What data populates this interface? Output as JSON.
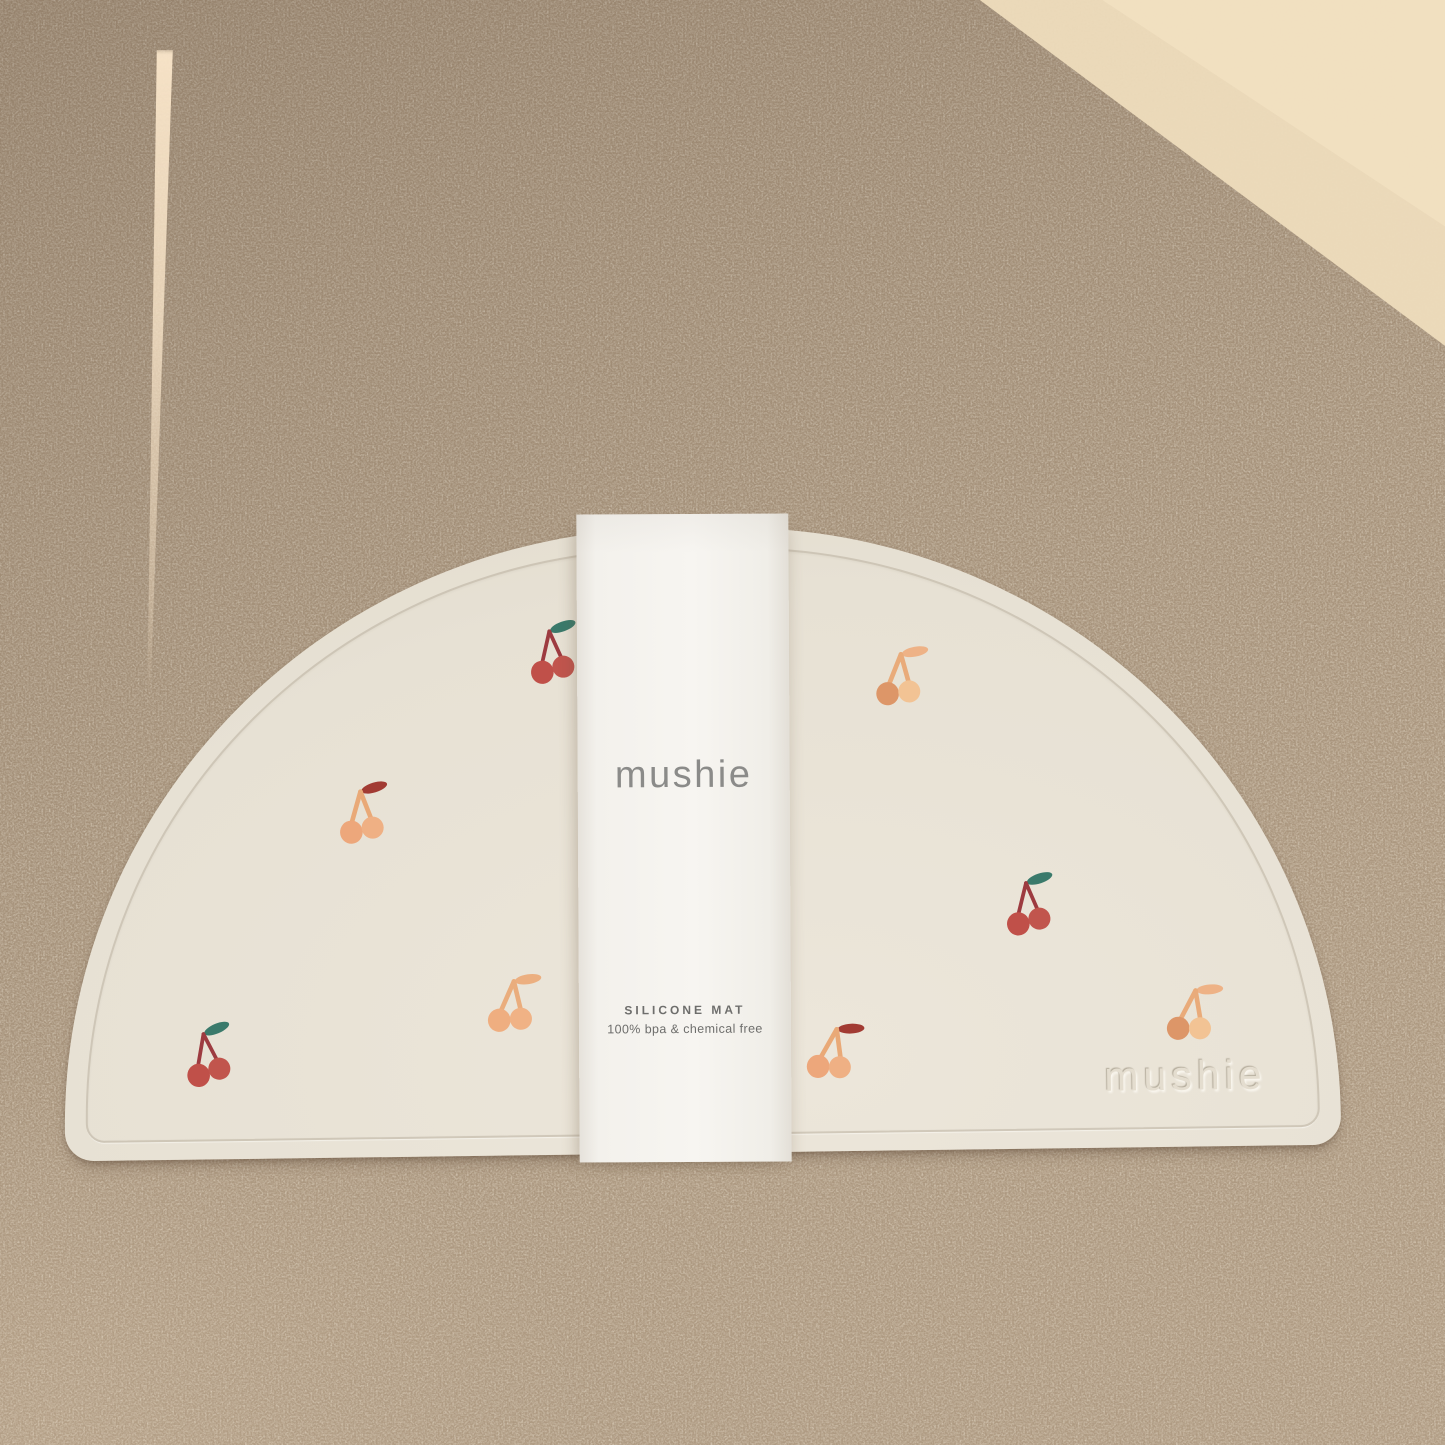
{
  "product": {
    "band": {
      "brand": "mushie",
      "product_name": "SILICONE MAT",
      "tagline": "100% bpa & chemical free"
    },
    "mat": {
      "embossed_logo": "mushie"
    }
  },
  "colors": {
    "cork_shadow": "#a8947c",
    "cork_sunlit": "#eedcbc",
    "mat_cream": "#e7e1d4",
    "band_white": "#f7f5f1",
    "cherry_red": "#c05049",
    "cherry_red_stem": "#9d3b40",
    "leaf_green": "#3a7a6b",
    "cherry_orange": "#eda77b",
    "leaf_dark_red": "#a23b33"
  },
  "cherry_variants": {
    "red": {
      "leaf": "#3a7a6b",
      "stem": "#9d3b40",
      "stem_width": 6.5,
      "body_left": "#c05049",
      "body_right": "#c1554d"
    },
    "orange_red_leaf": {
      "leaf": "#a23b33",
      "stem": "#e9a977",
      "stem_width": 8,
      "body_left": "#eda77b",
      "body_right": "#efb084"
    },
    "orange": {
      "leaf": "#eeb286",
      "stem": "#e9ab7a",
      "stem_width": 8,
      "body_left": "#dd9668",
      "body_right": "#f2c394"
    },
    "orange_soft": {
      "leaf": "#ecaf80",
      "stem": "#eaad7d",
      "stem_width": 8,
      "body_left": "#efae80",
      "body_right": "#f0b285"
    }
  },
  "icons": {
    "cherries": [
      {
        "id": "cherry-top-left-red",
        "variant": "red",
        "x": 466,
        "y": 90,
        "rot": -5
      },
      {
        "id": "cherry-left-orange",
        "variant": "orange_red_leaf",
        "x": 274,
        "y": 248,
        "rot": -2
      },
      {
        "id": "cherry-bottom-left-red",
        "variant": "red",
        "x": 116,
        "y": 488,
        "rot": -8
      },
      {
        "id": "cherry-mid-left-orange",
        "variant": "orange_soft",
        "x": 422,
        "y": 440,
        "rot": 6
      },
      {
        "id": "cherry-right-top-orange",
        "variant": "orange",
        "x": 814,
        "y": 118,
        "rot": 4
      },
      {
        "id": "cherry-right-red",
        "variant": "red",
        "x": 939,
        "y": 348,
        "rot": -4
      },
      {
        "id": "cherry-bottom-mid-orange",
        "variant": "orange_red_leaf",
        "x": 742,
        "y": 492,
        "rot": 12
      },
      {
        "id": "cherry-right-low-orange",
        "variant": "orange",
        "x": 1102,
        "y": 458,
        "rot": 10
      }
    ]
  }
}
